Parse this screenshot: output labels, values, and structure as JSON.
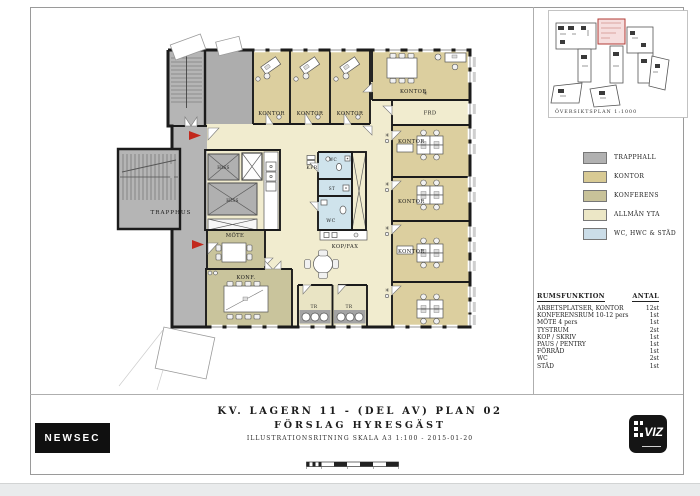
{
  "drawing": {
    "title_block": {
      "line1": "KV. LAGERN 11 - (DEL AV) PLAN 02",
      "line2": "FÖRSLAG HYRESGÄST",
      "line3": "ILLUSTRATIONSRITNING SKALA A3 1:100 - 2015-01-20"
    },
    "overview": {
      "title": "ÖVERSIKTSPLAN 1:1000"
    },
    "legend": [
      {
        "label": "TRAPPHALL",
        "color": "#b1b1b1"
      },
      {
        "label": "KONTOR",
        "color": "#d8ca94"
      },
      {
        "label": "KONFERENS",
        "color": "#c8c299"
      },
      {
        "label": "ALLMÄN YTA",
        "color": "#ece7c6"
      },
      {
        "label": "WC, HWC & STÄD",
        "color": "#cbdde8"
      }
    ],
    "room_table": {
      "col_function": "RUMSFUNKTION",
      "col_count": "ANTAL",
      "rows": [
        {
          "label": "ARBETSPLATSER, KONTOR",
          "count": "12st"
        },
        {
          "label": "KONFERENSRUM 10-12 pers",
          "count": "1st"
        },
        {
          "label": "MÖTE 4 pers",
          "count": "1st"
        },
        {
          "label": "TYSTRUM",
          "count": "2st"
        },
        {
          "label": "KOP / SKRIV",
          "count": "1st"
        },
        {
          "label": "PAUS / PENTRY",
          "count": "1st"
        },
        {
          "label": "FÖRRÅD",
          "count": "1st"
        },
        {
          "label": "WC",
          "count": "2st"
        },
        {
          "label": "STÄD",
          "count": "1st"
        }
      ]
    },
    "plan_labels": {
      "trapphus": "TRAPPHUS",
      "hiss": "HISS",
      "mote": "MÖTE",
      "konf": "KONF.",
      "kontor": "KONTOR",
      "frd": "FRD",
      "kpr": "KPR",
      "st": "ST",
      "wc": "WC",
      "kopfax": "KOP/FAX",
      "tr": "TR"
    },
    "colors": {
      "wall": "#1b1b1b",
      "accent_red": "#c2281c",
      "trapphall": "#b5b5b5",
      "kontor": "#dccf9f",
      "konferens": "#c9c49c",
      "allman_yta": "#f1eccf",
      "wc_stad": "#cfe3ec"
    },
    "logos": {
      "newsec": "NEWSEC",
      "viz": "VIZ"
    }
  }
}
